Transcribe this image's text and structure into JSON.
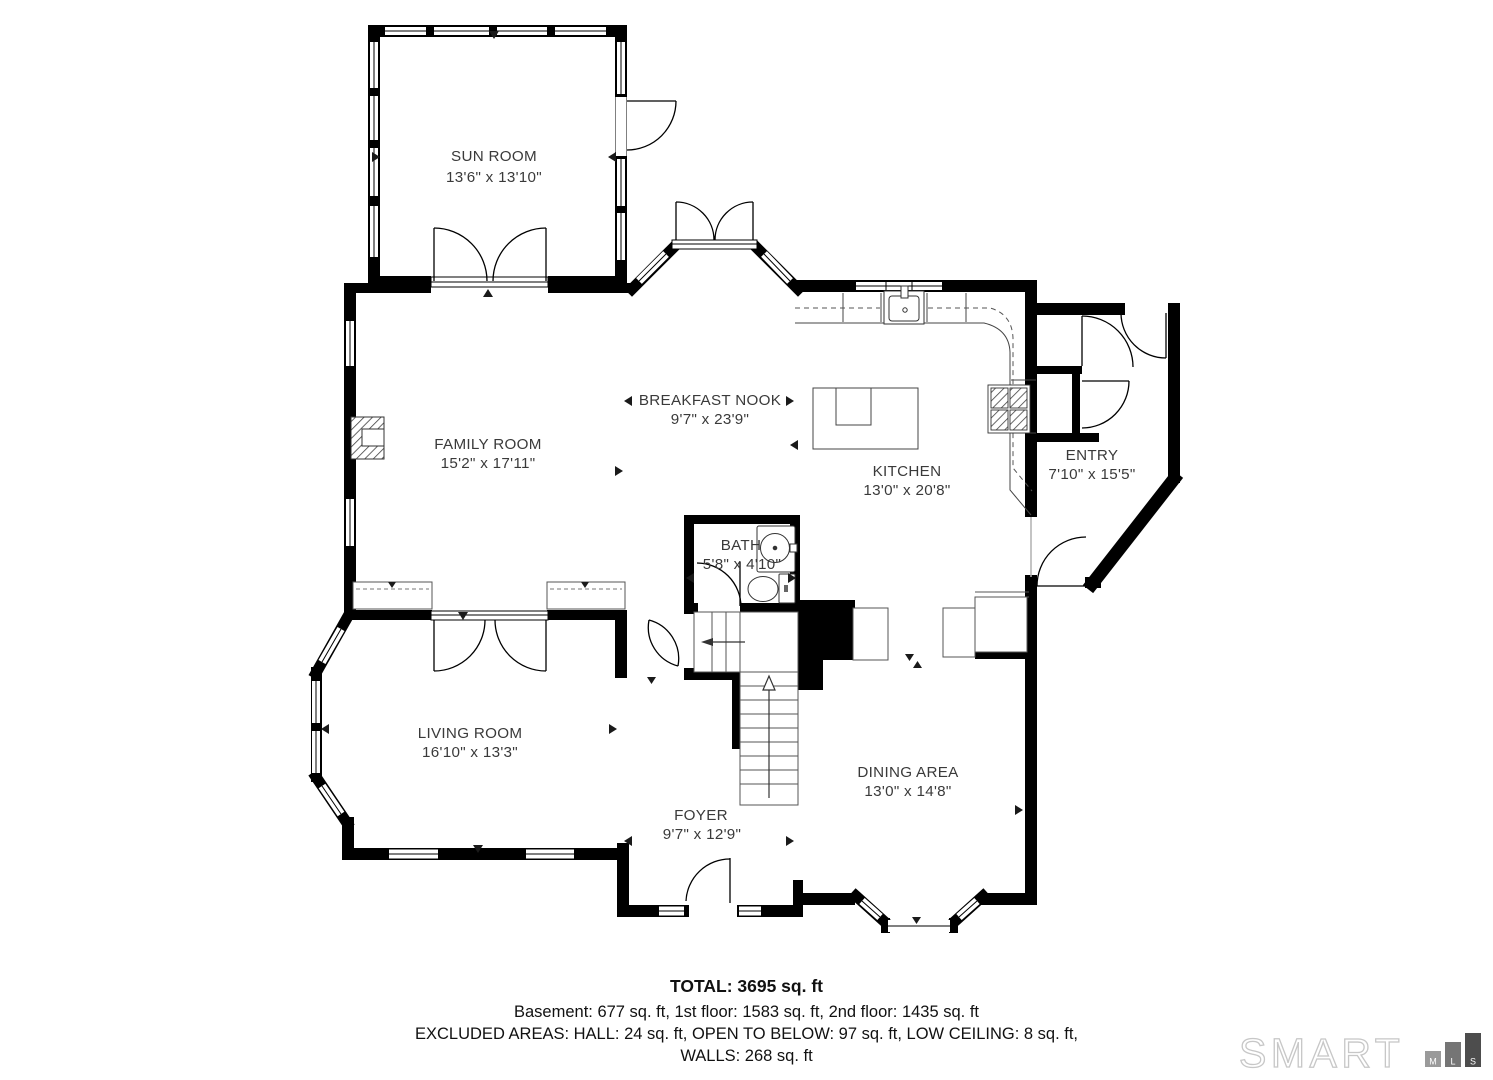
{
  "rooms": [
    {
      "name": "SUN ROOM",
      "dims": "13'6\" x 13'10\""
    },
    {
      "name": "FAMILY ROOM",
      "dims": "15'2\" x 17'11\""
    },
    {
      "name": "BREAKFAST NOOK",
      "dims": "9'7\" x 23'9\""
    },
    {
      "name": "KITCHEN",
      "dims": "13'0\" x 20'8\""
    },
    {
      "name": "ENTRY",
      "dims": "7'10\" x 15'5\""
    },
    {
      "name": "BATH",
      "dims": "5'8\" x 4'10\""
    },
    {
      "name": "LIVING ROOM",
      "dims": "16'10\" x 13'3\""
    },
    {
      "name": "FOYER",
      "dims": "9'7\" x 12'9\""
    },
    {
      "name": "DINING AREA",
      "dims": "13'0\" x 14'8\""
    }
  ],
  "summary": {
    "total": "TOTAL: 3695 sq. ft",
    "floors": "Basement: 677 sq. ft, 1st floor: 1583 sq. ft, 2nd floor: 1435 sq. ft",
    "excluded": "EXCLUDED AREAS: HALL: 24 sq. ft, OPEN TO BELOW: 97 sq. ft, LOW CEILING: 8 sq. ft,",
    "walls": "WALLS: 268 sq. ft"
  },
  "branding": {
    "word": "SMART",
    "boxes": [
      "M",
      "L",
      "S"
    ]
  },
  "colors": {
    "wall": "#000000",
    "label_text": "#3a3a3a",
    "logo_outline": "#c7c7c7",
    "logo_box_m": "#9a9a9a",
    "logo_box_l": "#757575",
    "logo_box_s": "#4d4d4d"
  }
}
